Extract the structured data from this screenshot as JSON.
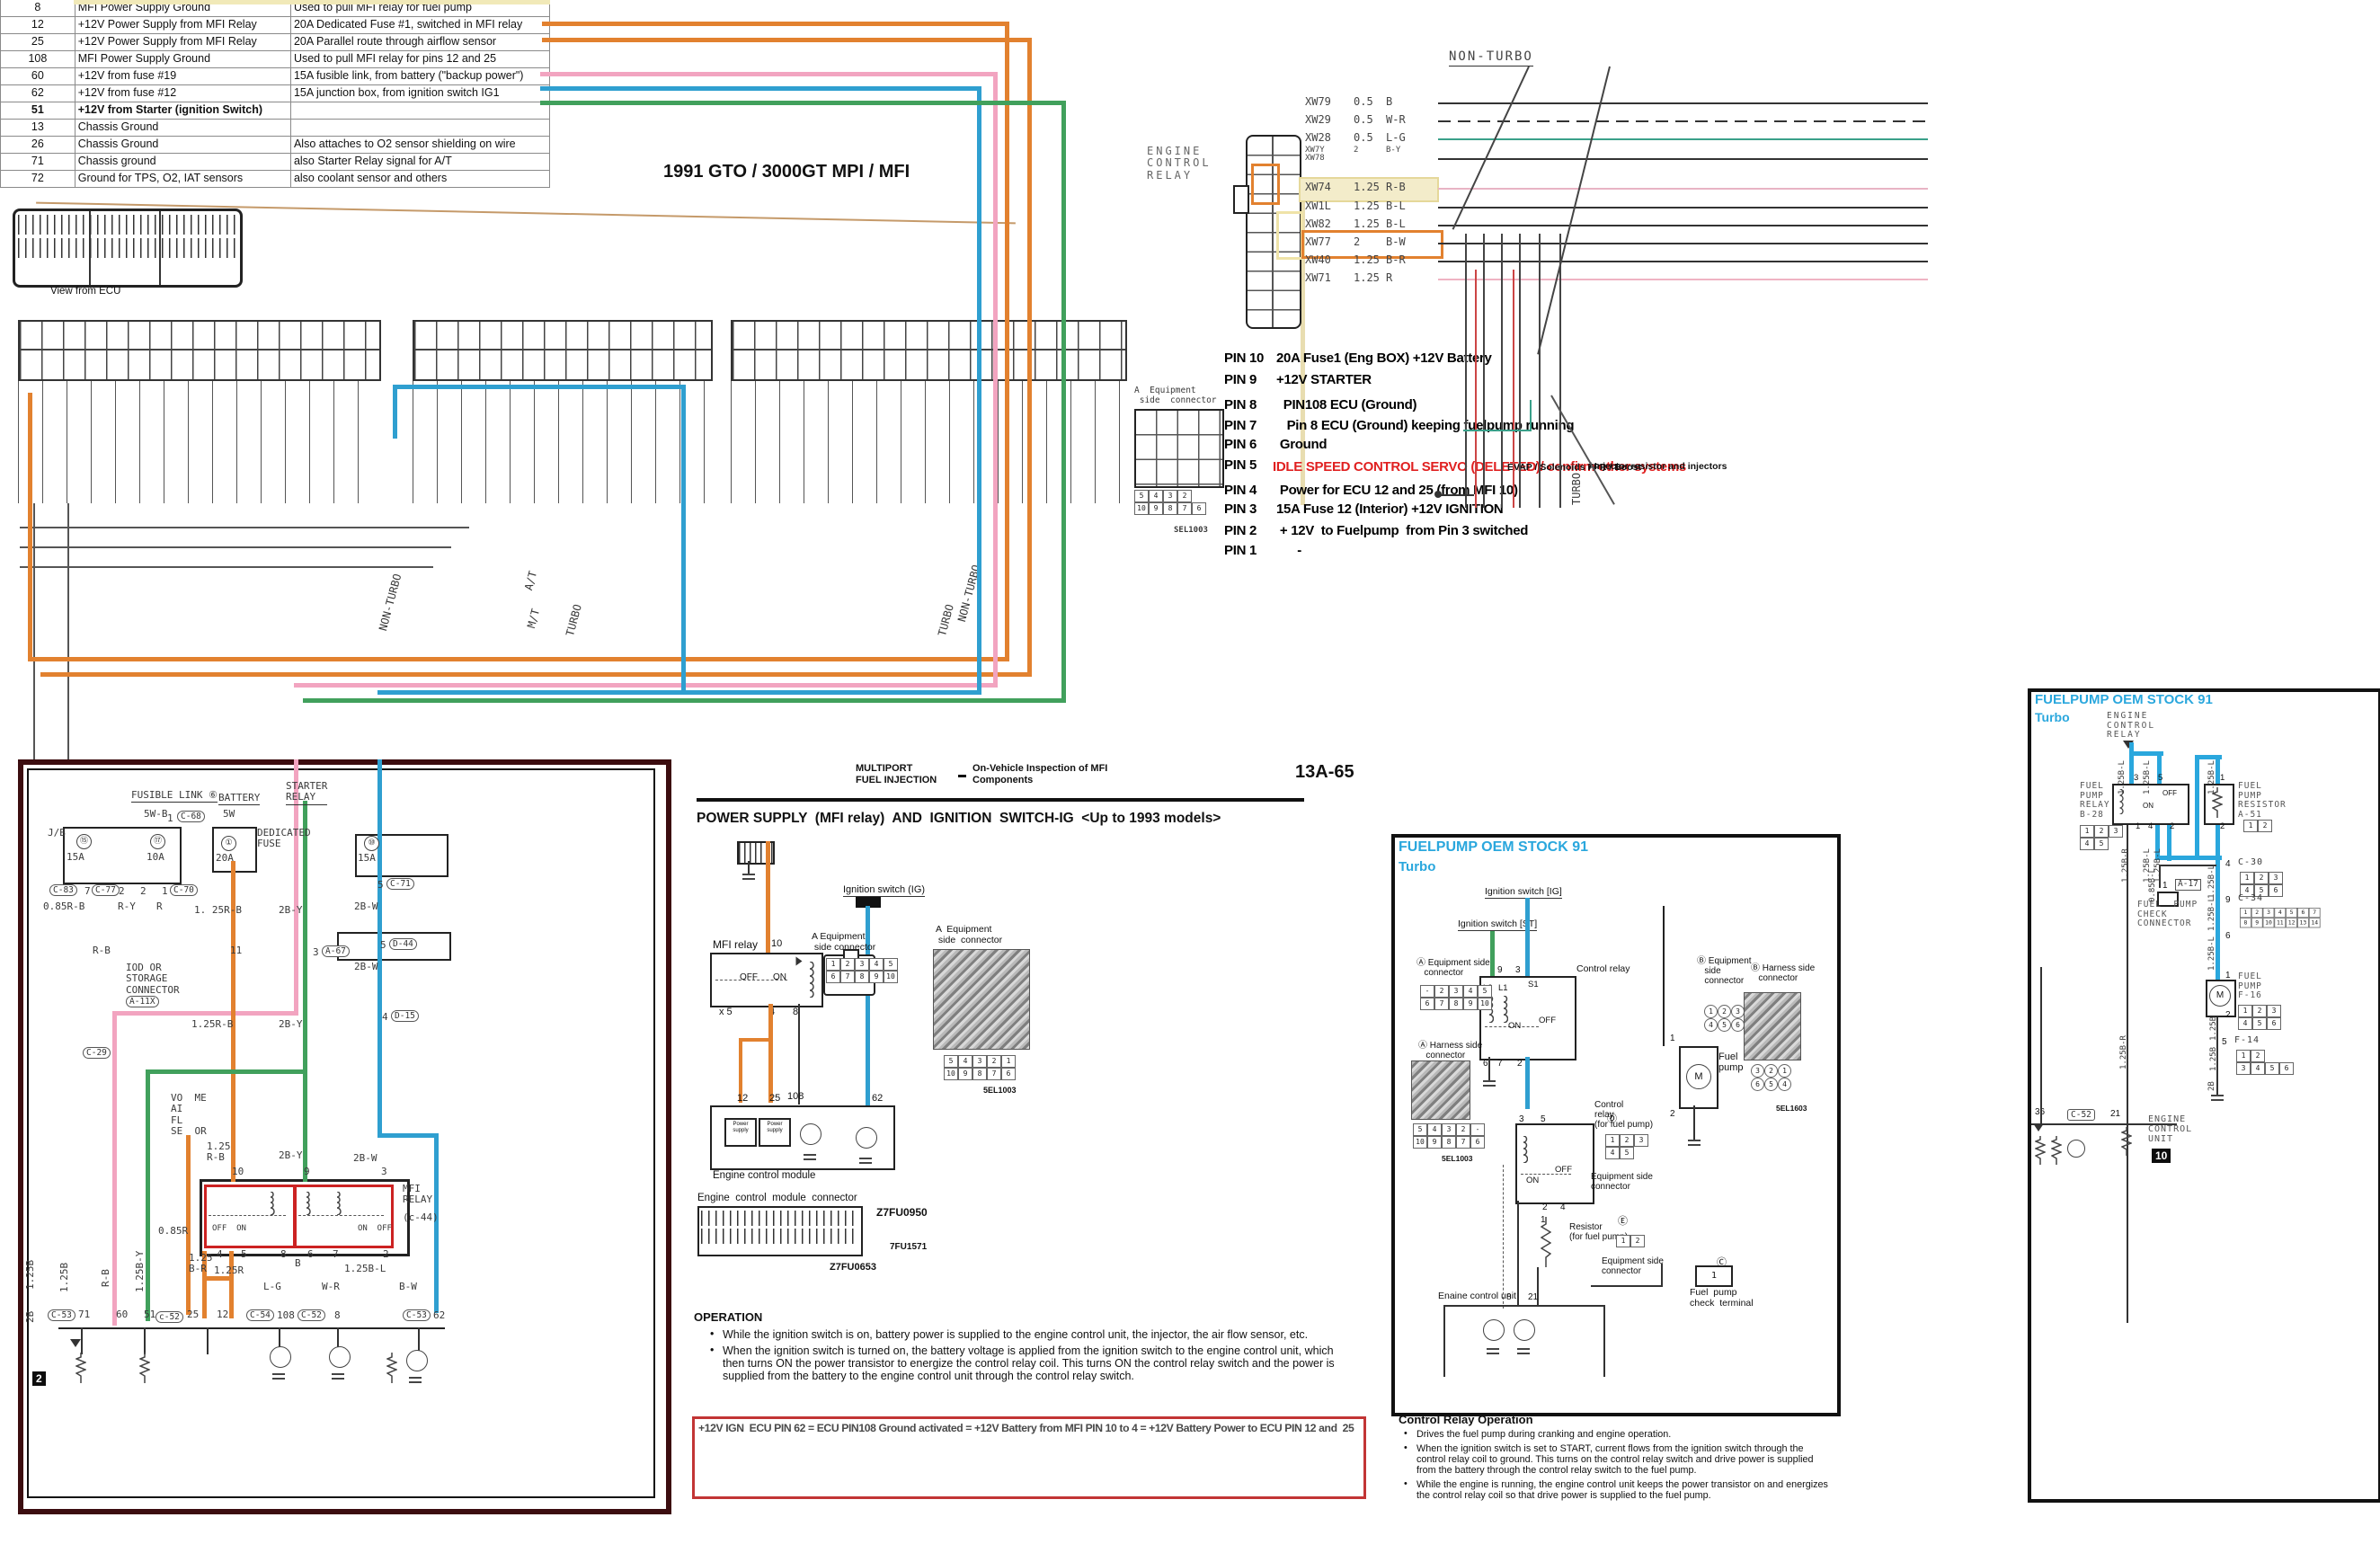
{
  "title": "1991 GTO / 3000GT MPI / MFI",
  "pin_table": {
    "caption": "View from ECU",
    "rows": [
      [
        "8",
        "MFI Power Supply Ground",
        "Used to pull MFI relay for fuel pump",
        0
      ],
      [
        "12",
        "+12V Power Supply from MFI Relay",
        "20A Dedicated Fuse #1, switched in MFI relay",
        0
      ],
      [
        "25",
        "+12V Power Supply from MFI Relay",
        "20A Parallel route through airflow sensor",
        0
      ],
      [
        "108",
        "MFI Power Supply Ground",
        "Used to pull MFI relay for pins 12 and 25",
        0
      ],
      [
        "60",
        "+12V from fuse #19",
        "15A fusible link, from battery (\"backup power\")",
        0
      ],
      [
        "62",
        "+12V from fuse #12",
        "15A junction box, from ignition switch IG1",
        0
      ],
      [
        "51",
        "+12V from Starter (ignition Switch)",
        "",
        1
      ],
      [
        "13",
        "Chassis Ground",
        "",
        0
      ],
      [
        "26",
        "Chassis Ground",
        "Also attaches to O2 sensor shielding on wire",
        0
      ],
      [
        "71",
        "Chassis ground",
        "also Starter Relay signal for A/T",
        0
      ],
      [
        "72",
        "Ground for TPS, O2, IAT sensors",
        "also coolant sensor and others",
        0
      ]
    ]
  },
  "ecr": {
    "label": "ENGINE\nCONTROL\nRELAY",
    "non_turbo": "NON-TURBO",
    "wires": [
      [
        "XW79",
        "0.5",
        "B"
      ],
      [
        "XW29",
        "0.5",
        "W-R"
      ],
      [
        "XW28",
        "0.5",
        "L-G"
      ],
      [
        "XW7Y\nXW78",
        "2",
        "B-Y"
      ],
      [
        "XW74",
        "1.25",
        "R-B"
      ],
      [
        "XW1L",
        "1.25",
        "B-L"
      ],
      [
        "XW82",
        "1.25",
        "B-L"
      ],
      [
        "XW77",
        "2",
        "B-W"
      ],
      [
        "XW40",
        "1.25",
        "B-R"
      ],
      [
        "XW71",
        "1.25",
        "R"
      ]
    ]
  },
  "pin_list": {
    "rows": [
      [
        "PIN 10",
        "20A Fuse1 (Eng BOX) +12V Battery"
      ],
      [
        "PIN 9",
        "+12V STARTER"
      ],
      [
        "PIN 8",
        "  PIN108 ECU (Ground)"
      ],
      [
        "PIN 7",
        "   Pin 8 ECU (Ground) keeping fuelpump running"
      ],
      [
        "PIN 6",
        " Ground"
      ],
      [
        "PIN 5",
        ""
      ],
      [
        "PIN 4",
        " Power for ECU 12 and 25 (from MFI 10)"
      ],
      [
        "PIN 3",
        "15A Fuse 12 (Interior) +12V IGNITION"
      ],
      [
        "PIN 2",
        " + 12V  to Fuelpump  from Pin 3 switched"
      ],
      [
        "PIN 1",
        "      -"
      ]
    ],
    "pin5_red": "IDLE SPEED CONTROL SERVO (DELETED)/ confirm other systems",
    "pin5_side": "EVAP / Solenoids FPR / Boost",
    "pin5_side2": "/ Injector resistor and injectors",
    "turbo": "TURBO"
  },
  "equip_conn": {
    "label": "A  Equipment\n side  connector",
    "rows": [
      "5 4 3 2",
      "10 9 8 7 6"
    ],
    "code": "SEL1003"
  },
  "band": {
    "rot": [
      "NON-TURBO",
      "A/T",
      "M/T",
      "TURBO",
      "TURBO",
      "NON-TURBO",
      "TURBO"
    ]
  },
  "ls": [
    "J/B",
    "FUSIBLE LINK ⑥",
    "5W-B",
    "1",
    "C-68",
    "BATTERY",
    "5W",
    "DEDICATED\nFUSE",
    "20A",
    "STARTER\nRELAY",
    "15A",
    "10A",
    "15A",
    "C-83",
    "7",
    "C-77",
    "2",
    "2",
    "1",
    "C-70",
    "0.85R-B",
    "R-Y",
    "R",
    "R-B",
    "1. 25R-B",
    "2B-Y",
    "5",
    "C-71",
    "IOD OR\nSTORAGE\nCONNECTOR",
    "A-11X",
    "11",
    "3",
    "A-67",
    "5",
    "D-44",
    "2B-W",
    "C-29",
    "4",
    "D-15",
    "VO  ME\nAI\nFL\nSE  OR",
    "1.25\nR-B",
    "2B-Y",
    "2B-W",
    "MFI\nRELAY",
    "(c-44)",
    "10",
    "9",
    "3",
    "OFF  ON",
    "ON  OFF",
    "4",
    "5",
    "8",
    "6",
    "7",
    "2",
    "1.25B",
    "1.25B",
    "R-B",
    "1.25B-Y",
    "0.85R",
    "1.25\nB-R",
    "1.25R",
    "B",
    "1.25B-L",
    "L-G",
    "W-R",
    "B-W",
    "2B",
    "C-53",
    "71",
    "60",
    "51",
    "c-52",
    "25",
    "12",
    "C-54",
    "108",
    "C-52",
    "8",
    "C-53",
    "62",
    "2",
    "①",
    "⑮",
    "⑰",
    "⑩",
    "2B-Y",
    "2B-W",
    "1.25R-B"
  ],
  "cp": {
    "h1a": "MULTIPORT",
    "h1b": "FUEL INJECTION",
    "h2a": "On-Vehicle Inspection of MFI",
    "h2b": "Components",
    "page_no": "13A-65",
    "title": "POWER SUPPLY  (MFI relay)  AND  IGNITION  SWITCH-IG  <Up to 1993 models>",
    "mfi_relay": "MFI relay",
    "pin10": "10",
    "off": "OFF",
    "on": "ON",
    "x5": "x 5",
    "p4": "4",
    "p8": "8",
    "ign": "Ignition switch (IG)",
    "eq1": "A Equipment\n side connector",
    "eq2": "A  Equipment\n side  connector",
    "g1": [
      "1 2 3 4 5",
      "6 7 8 9 10"
    ],
    "g2": [
      "5 4 3 2 1",
      "10 9 8 7 6"
    ],
    "sel": "5EL1003",
    "p12": "12",
    "p25": "25",
    "p108": "108",
    "p62": "62",
    "ps": "Power\nsupply",
    "ecm": "Engine control module",
    "ecm_conn": "Engine  control  module  connector",
    "code1": "Z7FU0950",
    "code2": "7FU1571",
    "code3": "Z7FU0653",
    "operation": "OPERATION",
    "op1": "While the ignition switch is on, battery power is supplied to the engine control unit, the injector, the air flow sensor, etc.",
    "op2": "When the ignition switch is turned on, the battery voltage is applied from the ignition switch to the engine control unit, which then turns ON the power transistor to energize the control relay coil. This turns ON the control relay switch and the power is supplied from the battery to the engine control unit through the control relay switch.",
    "redbox": "+12V IGN  ECU PIN 62 = ECU PIN108 Ground activated = +12V Battery from MFI PIN 10 to 4 = +12V Battery Power to ECU PIN 12 and  25"
  },
  "fp": {
    "title1": "FUELPUMP OEM STOCK 91",
    "title2": "Turbo",
    "ign_ig": "Ignition switch [IG]",
    "ign_st": "Ignition switch [ST]",
    "ctrl_relay": "Control relay",
    "ctrl_relay_fp": "Control\nrelay\n(for fuel pump)",
    "l2": "L2",
    "l1": "L1",
    "s1": "S1",
    "on": "ON",
    "off": "OFF",
    "on2": "ON",
    "off2": "OFF",
    "p9": "9",
    "p3": "3",
    "p6": "6",
    "p7": "7",
    "p2": "2",
    "r3": "3",
    "r5": "5",
    "r2": "2",
    "r4": "4",
    "r1": "1",
    "eqA": "Ⓐ Equipment side\n   connector",
    "haA": "Ⓐ Harness side\n   connector",
    "gA": [
      "- 2 3 4 5",
      "6 7 8 9 10"
    ],
    "gAh": [
      "5 4 3 2 -",
      "10 9 8 7 6"
    ],
    "selA": "5EL1003",
    "dD": "Ⓓ",
    "gD": [
      "1 2 3",
      "4 5"
    ],
    "eqD": "Equipment side\nconnector",
    "resistor": "Resistor\n(for fuel pump)",
    "eE": "Ⓔ",
    "gE": [
      "1 2"
    ],
    "eqE": "Equipment side\nconnector",
    "eqB": "Ⓑ Equipment\n   side\n   connector",
    "haB": "Ⓑ Harness side\n   connector",
    "gB": [
      "1 2 3",
      "4 5 6"
    ],
    "gBh": [
      "3 2 1",
      "6 5 4"
    ],
    "selB": "5EL1603",
    "pump1": "1",
    "pump2": "2",
    "fuel": "Fuel\npump",
    "m": "M",
    "ecu": "Enaine control unit",
    "e8": "8",
    "e21": "21",
    "cC": "Ⓒ",
    "c1": "1",
    "check": "Fuel  pump\ncheck  terminal",
    "cro_title": "Control Relay Operation",
    "cro1": "Drives the fuel pump during cranking and engine operation.",
    "cro2": "When the ignition switch is set to START, current flows from the ignition switch through the control relay coil to ground. This turns on the control relay switch and drive power is supplied from the battery through the control relay switch to the fuel pump.",
    "cro3": "While the engine is running, the engine control unit keeps the power transistor on and energizes the control relay coil so that drive power is supplied to the fuel pump."
  },
  "rp": {
    "title1": "FUELPUMP OEM STOCK 91",
    "title2": "Turbo",
    "ecr": "ENGINE\nCONTROL\nRELAY",
    "fpr": "FUEL\nPUMP\nRELAY\nB-28",
    "fprr": "FUEL\nPUMP\nRESISTOR\nA-51",
    "gB28": [
      "1 2 3",
      "4 5"
    ],
    "gA51": [
      "1 2"
    ],
    "p3": "3",
    "p5": "5",
    "p1": "1",
    "p4": "4",
    "p2": "2",
    "pr1": "1",
    "pr2": "2",
    "off": "OFF",
    "on": "ON",
    "n4": "4",
    "c30": "C-30",
    "g30": [
      "1 2 3",
      "4 5 6"
    ],
    "n1a": "1",
    "a17": "A-17",
    "fpc": "FUEL  PUMP\nCHECK\nCONNECTOR",
    "n9": "9",
    "c34": "C-34",
    "g34": [
      "1 2 3 4 5 6 7",
      "8 9 10 11 12 13 14"
    ],
    "n6": "6",
    "np1": "1",
    "np2": "2",
    "m": "M",
    "fpump": "FUEL\nPUMP\nF-16",
    "gF16": [
      "1 2 3",
      "4 5 6"
    ],
    "n5": "5",
    "f14": "F-14",
    "gF14": [
      "1 2",
      "3 4 5 6"
    ],
    "n36": "36",
    "c52": "C-52",
    "n21": "21",
    "ecu": "ENGINE\nCONTROL\nUNIT",
    "n10": "10",
    "wl": [
      "1.25B-L",
      "1.25B-L",
      "1.25B-L",
      "1.25B-R",
      "1.25B-L",
      "1.25B-L",
      "1.25B-L",
      "0.85B-L",
      "1.25B-L",
      "1.25B-L",
      "1.25B",
      "1.25B",
      "2B",
      "1.25B-R"
    ]
  },
  "colors": {
    "orange": "#e2812f",
    "pink": "#f2a4c0",
    "blue": "#2f9fd0",
    "green": "#41a05c",
    "teal": "#3aa08a",
    "cyan": "#2aa7dd",
    "red_text": "#e02020",
    "red_box": "#c23535",
    "maroon": "#3c0d10",
    "relay_red": "#cc2222",
    "cream": "#f3ecca"
  }
}
